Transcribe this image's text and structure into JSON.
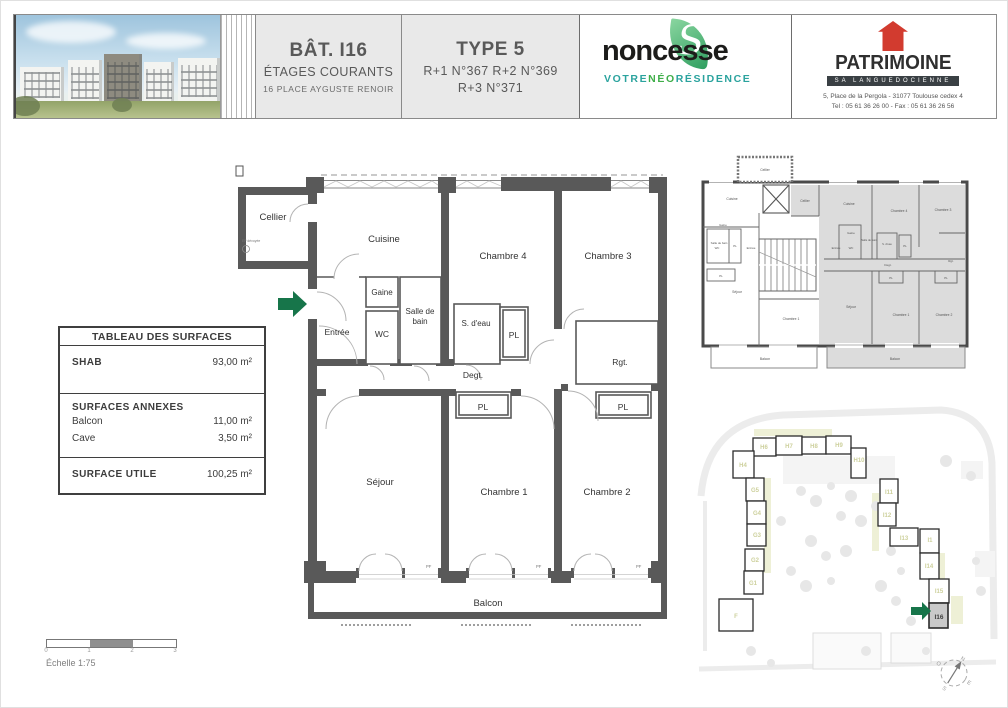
{
  "header": {
    "bat": {
      "title": "BÂT. I16",
      "line2": "ÉTAGES COURANTS",
      "line3": "16 PLACE AYGUSTE RENOIR"
    },
    "type": {
      "title": "TYPE 5",
      "line2": "R+1 N°367  R+2 N°369",
      "line3": "R+3 N°371"
    },
    "noncesse": {
      "name": "noncesse",
      "s": "S",
      "tag1": "VOTRE",
      "tag2": "NÉO",
      "tag3": "RÉSIDENCE"
    },
    "patrimoine": {
      "name": "PATRIMOINE",
      "sub": "SA LANGUEDOCIENNE",
      "addr": "5, Place de la Pergola - 31077 Toulouse cedex 4",
      "tel": "Tel : 05 61 36 26 00 - Fax : 05 61 36 26 56"
    }
  },
  "table": {
    "title": "TABLEAU DES SURFACES",
    "shab_label": "SHAB",
    "shab_value": "93,00 m²",
    "annexes_label": "SURFACES ANNEXES",
    "balcon_label": "Balcon",
    "balcon_value": "11,00 m²",
    "cave_label": "Cave",
    "cave_value": "3,50 m²",
    "utile_label": "SURFACE UTILE",
    "utile_value": "100,25 m²"
  },
  "plan": {
    "labels": {
      "cellier": "Cellier",
      "cuisine": "Cuisine",
      "chambre4": "Chambre 4",
      "chambre3": "Chambre 3",
      "gaine": "Gaine",
      "salle_de": "Salle de",
      "bain": "bain",
      "wc": "WC",
      "entree": "Entrée",
      "s_deau": "S. d'eau",
      "pl": "PL",
      "degt": "Degt.",
      "rgt": "Rgt.",
      "sejour": "Séjour",
      "chambre1": "Chambre 1",
      "chambre2": "Chambre 2",
      "balcon": "Balcon",
      "pf": "PF",
      "note": "EP dévoyée"
    }
  },
  "mini": {
    "labels": {
      "cellier": "Cellier",
      "cuisine": "Cuisine",
      "chambre4": "Chambre 4",
      "chambre3": "Chambre 3",
      "gaine": "Gaine",
      "salle_de_bain": "Salle de bain",
      "wc": "WC",
      "entree": "Entrée",
      "s_deau": "S. d'eau",
      "pl": "PL",
      "degt": "Degt.",
      "rgt": "Rgt.",
      "sejour": "Séjour",
      "chambre1": "Chambre 1",
      "chambre2": "Chambre 2",
      "balcon": "Balcon"
    }
  },
  "site": {
    "buildings": [
      "H6",
      "H7",
      "H8",
      "H9",
      "H10",
      "H4",
      "G5",
      "G4",
      "G3",
      "G2",
      "G1",
      "F",
      "I11",
      "I12",
      "I13",
      "I1",
      "I14",
      "I15",
      "I16"
    ],
    "highlight": "I16",
    "compass": {
      "n": "N",
      "e": "E",
      "s": "S",
      "o": "O"
    }
  },
  "scalebar": {
    "ticks": [
      "0",
      "1",
      "2",
      "3"
    ],
    "label": "Échelle 1:75"
  },
  "colors": {
    "accent_green": "#17754a",
    "patrimoine_red": "#d23b2f",
    "teal": "#2ba39e",
    "logo_green": "#3fae49",
    "wall_gray": "#595959",
    "mini_unit_gray": "#dcdcdc",
    "header_cell_gray": "#e9e9e9"
  }
}
